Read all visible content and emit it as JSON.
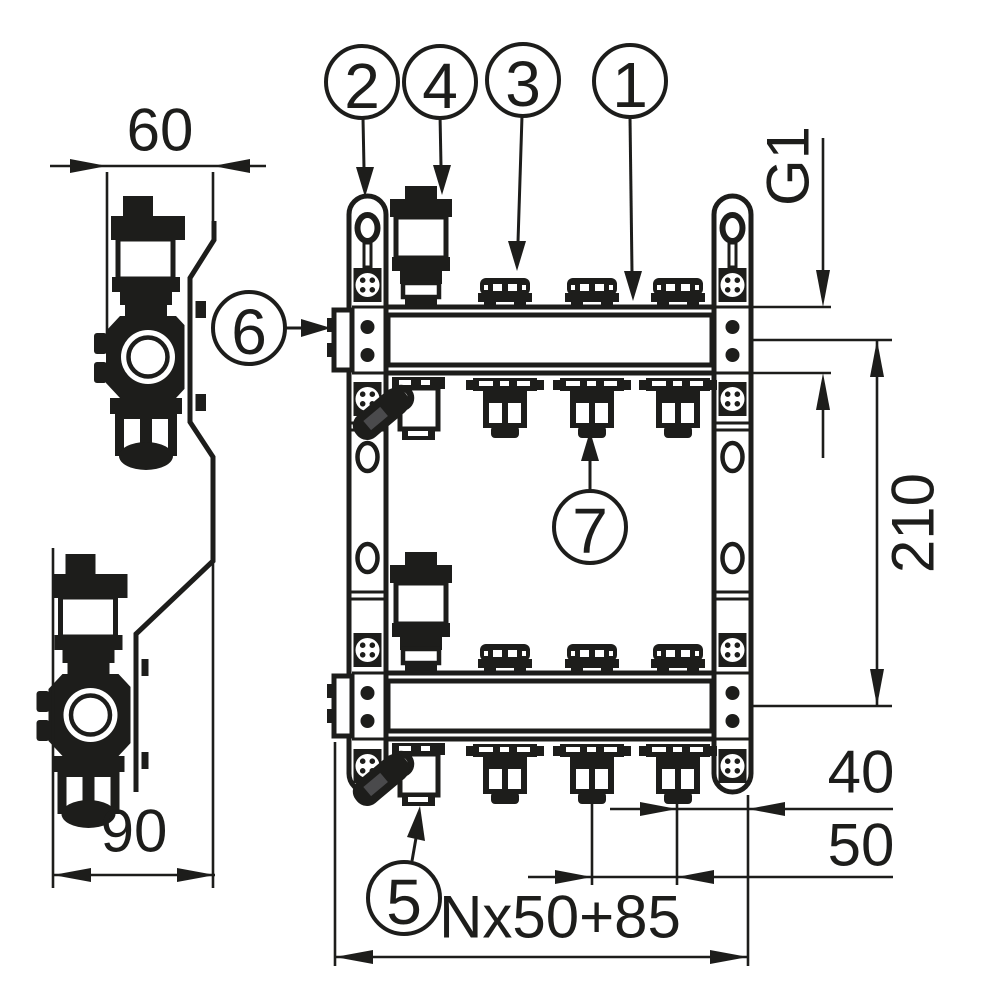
{
  "colors": {
    "line": "#1d1d1b",
    "background": "#ffffff",
    "handle_detail": "#4a4a4c"
  },
  "dimensions": {
    "width_top": "60",
    "width_bottom": "90",
    "connection_thread": "G1",
    "center_distance": "210",
    "end_offset": "40",
    "outlet_spacing": "50",
    "total_length": "Nx50+85"
  },
  "callouts": [
    {
      "label": "1",
      "points_to": "manifold-beam"
    },
    {
      "label": "2",
      "points_to": "mounting-rail"
    },
    {
      "label": "3",
      "points_to": "circuit-valve-cap"
    },
    {
      "label": "4",
      "points_to": "air-vent-valve"
    },
    {
      "label": "5",
      "points_to": "drain-valve"
    },
    {
      "label": "6",
      "points_to": "end-connection"
    },
    {
      "label": "7",
      "points_to": "outlet-fitting"
    }
  ]
}
